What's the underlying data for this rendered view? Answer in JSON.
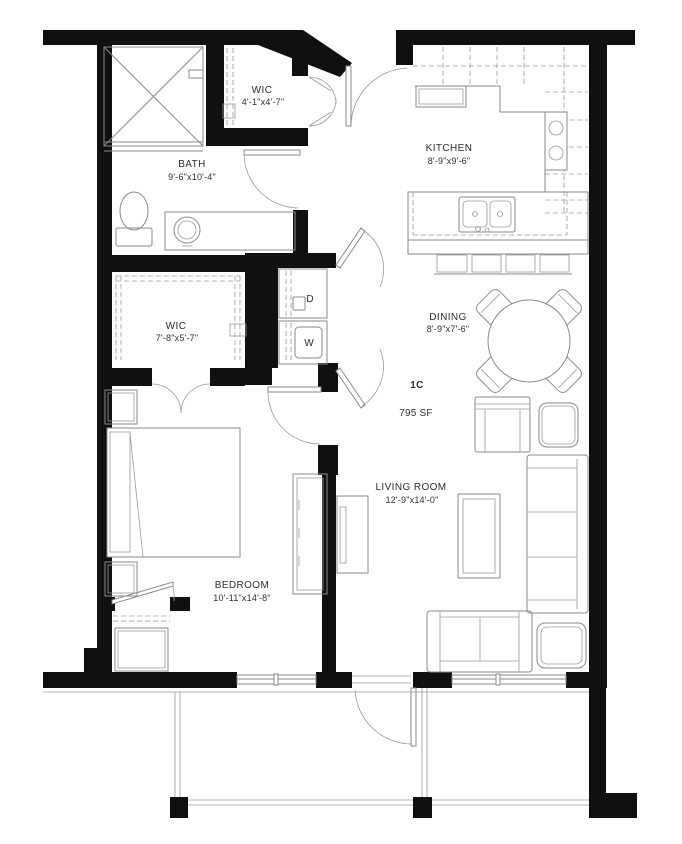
{
  "unit": {
    "label": "1C",
    "area": "795 SF"
  },
  "rooms": {
    "wic_upper": {
      "name": "WIC",
      "dims": "4'-1\"x4'-7\""
    },
    "bath": {
      "name": "BATH",
      "dims": "9'-6\"x10'-4\""
    },
    "kitchen": {
      "name": "KITCHEN",
      "dims": "8'-9\"x9'-6\""
    },
    "wic_lower": {
      "name": "WIC",
      "dims": "7'-8\"x5'-7\""
    },
    "dining": {
      "name": "DINING",
      "dims": "8'-9\"x7'-6\""
    },
    "living": {
      "name": "LIVING ROOM",
      "dims": "12'-9\"x14'-0\""
    },
    "bedroom": {
      "name": "BEDROOM",
      "dims": "10'-11\"x14'-8\""
    }
  },
  "appliances": {
    "dryer": "D",
    "washer": "W"
  },
  "colors": {
    "wall": "#101010",
    "line": "#8a8a8a",
    "text": "#2e2e2e",
    "background": "#ffffff"
  }
}
